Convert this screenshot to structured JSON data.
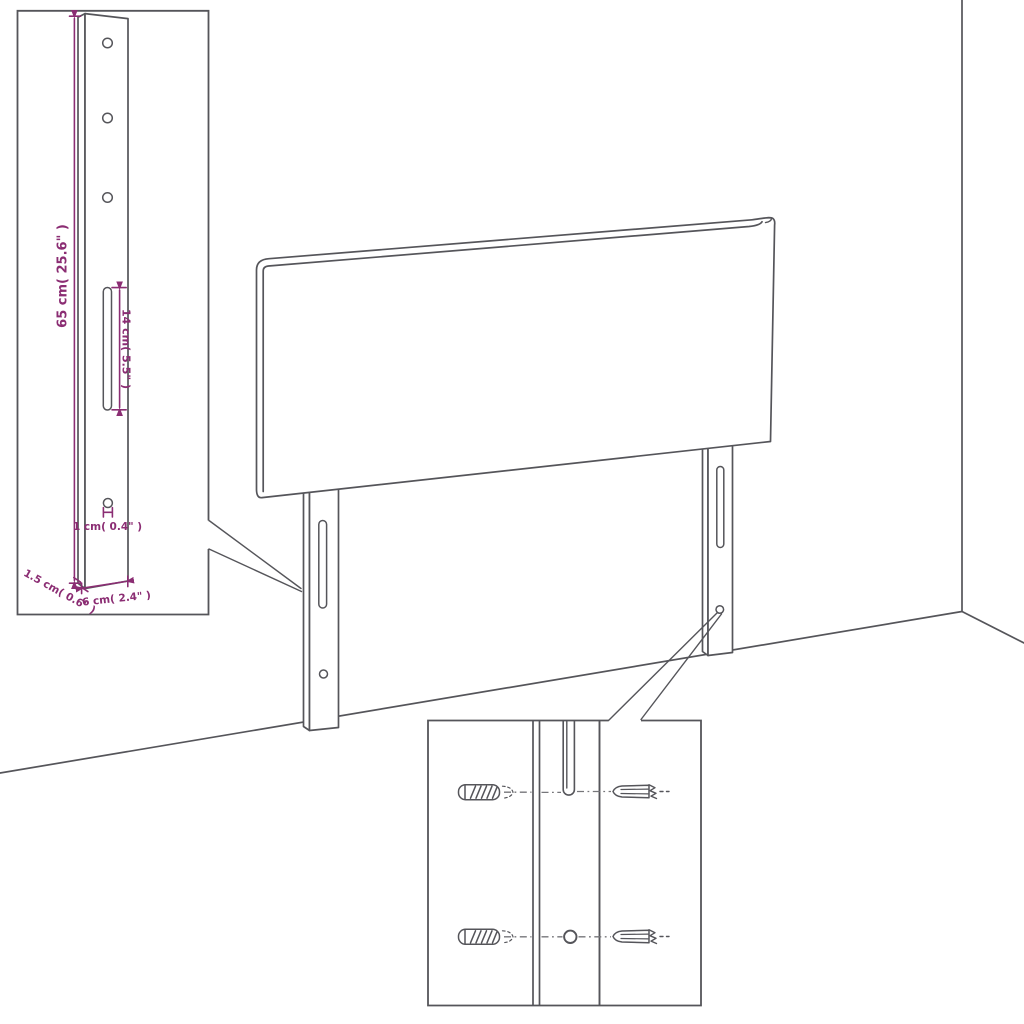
{
  "colors": {
    "background": "#ffffff",
    "line": "#55555a",
    "dimension": "#8b2d73"
  },
  "diagram": {
    "subject": "headboard with two slotted mounting legs shown against a room corner",
    "leg_detail_inset": {
      "description": "enlarged view of one mounting leg",
      "dimensions": {
        "height": "65 cm( 25.6\" )",
        "slot_length": "14 cm( 5.5\" )",
        "hole_diameter": "1 cm( 0.4\" )",
        "thickness": "1.5 cm( 0.6\" )",
        "width": "6 cm( 2.4\" )"
      },
      "features": [
        "mounting-hole",
        "mounting-hole",
        "mounting-hole",
        "adjustment-slot",
        "screw-hole"
      ]
    },
    "mounting_detail_inset": {
      "description": "close-up of leg slot and hole with wall plugs and screws",
      "hardware": [
        "wall-plug",
        "screw"
      ]
    }
  }
}
